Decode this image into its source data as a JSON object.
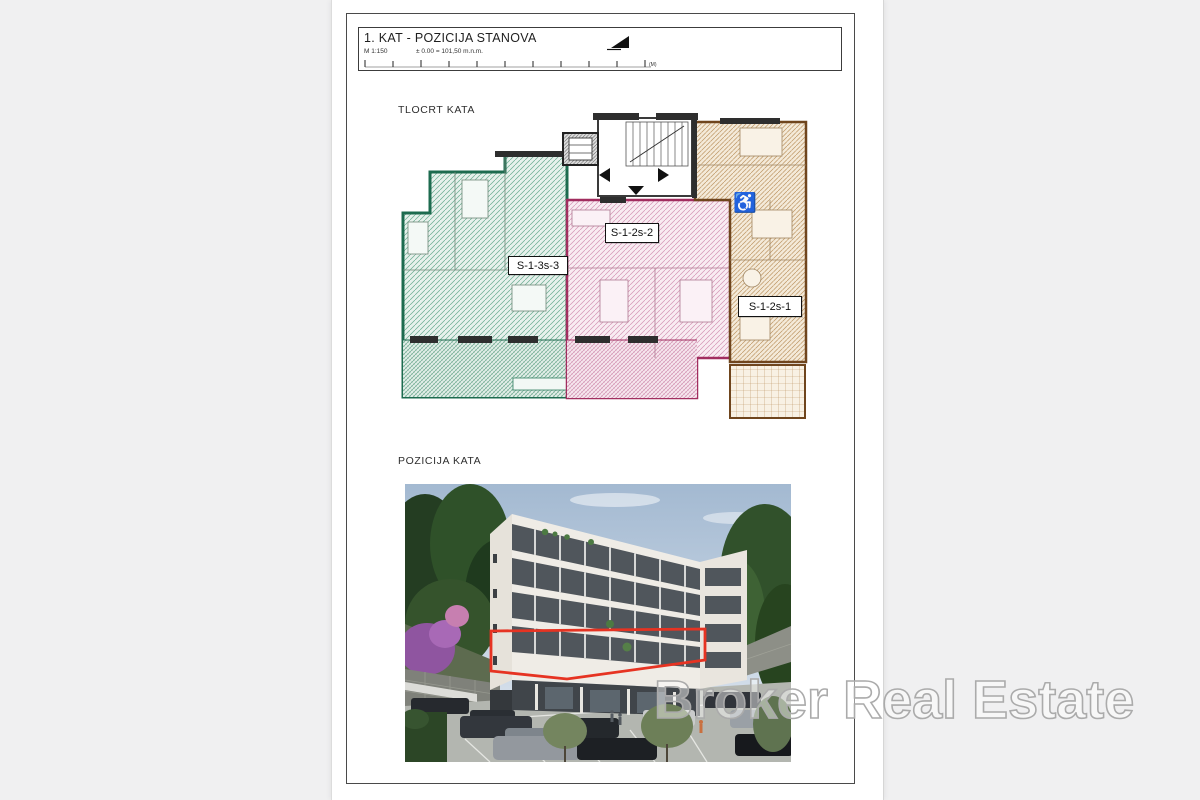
{
  "document": {
    "background_color": "#f0f0f1",
    "paper_color": "#ffffff"
  },
  "title_block": {
    "title": "1. KAT - POZICIJA STANOVA",
    "scale_label": "M 1:150",
    "elevation_label": "± 0.00 = 101,50 m.n.m.",
    "scale_bar_unit": "(M)"
  },
  "floor_plan": {
    "section_label": "TLOCRT KATA",
    "apartments": [
      {
        "id": "S-1-3s-3",
        "outline_color": "#1d6b4f",
        "fill_color": "#e7f1ec"
      },
      {
        "id": "S-1-2s-2",
        "outline_color": "#a12d5f",
        "fill_color": "#f9ecf2"
      },
      {
        "id": "S-1-2s-1",
        "outline_color": "#6f451d",
        "fill_color": "#f4ead9"
      }
    ],
    "accessible_icon": "♿"
  },
  "floor_position": {
    "section_label": "POZICIJA KATA",
    "highlight_color": "#e63322"
  },
  "watermark": {
    "text": "Broker Real Estate",
    "color": "#ababab"
  }
}
